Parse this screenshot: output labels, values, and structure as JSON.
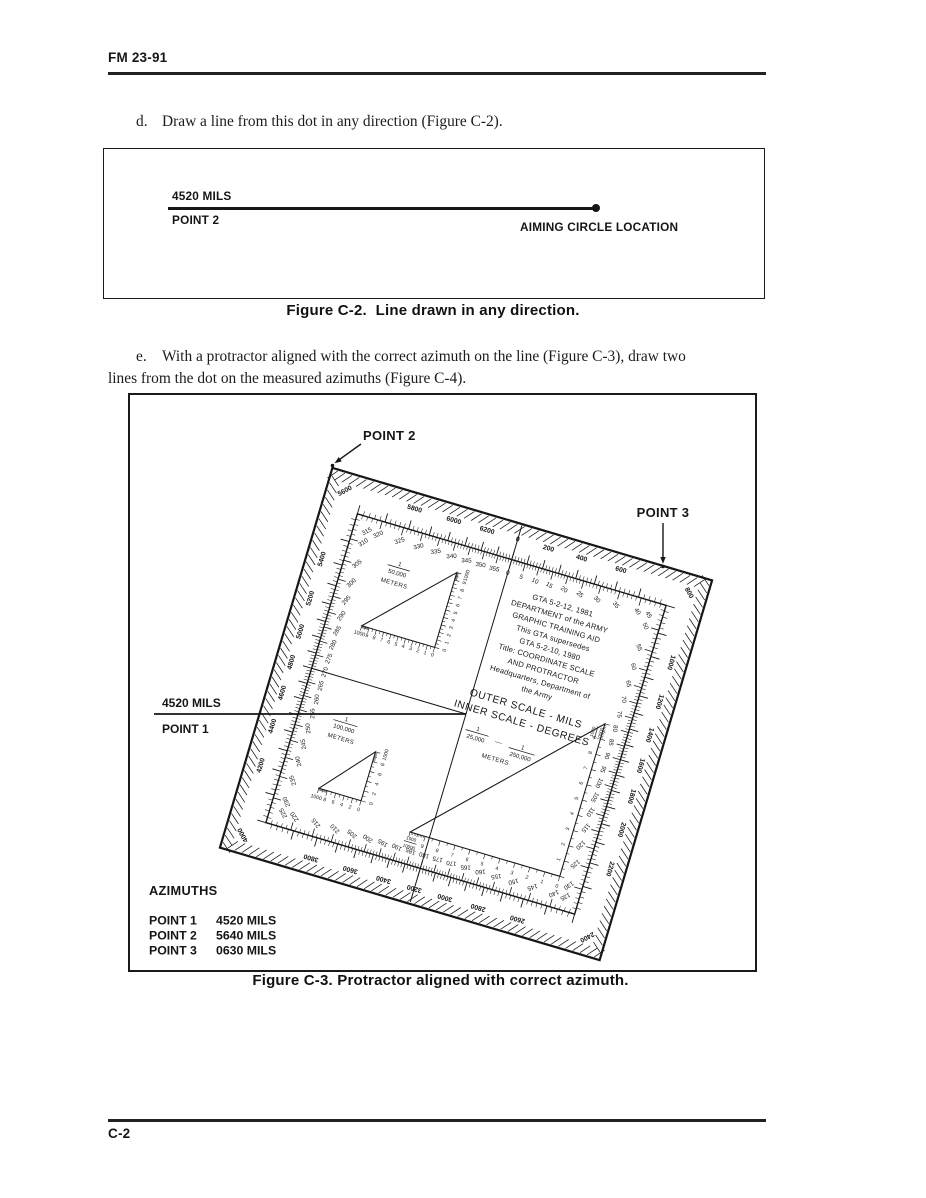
{
  "page": {
    "header_code": "FM 23-91",
    "footer_code": "C-2"
  },
  "paragraphs": {
    "d": {
      "label": "d.",
      "text": "Draw a line from this dot in any direction (Figure C-2)."
    },
    "e": {
      "label": "e.",
      "line1": "With a protractor aligned with the correct azimuth on the line (Figure C-3), draw two",
      "line2": "lines from the dot on the measured azimuths (Figure C-4)."
    }
  },
  "figure_c2": {
    "azimuth_label": "4520 MILS",
    "point_label": "POINT 2",
    "location_label": "AIMING CIRCLE LOCATION",
    "caption": "Figure C-2.  Line drawn in any direction."
  },
  "figure_c3": {
    "caption": "Figure C-3. Protractor aligned with correct azimuth.",
    "point2_label": "POINT 2",
    "point3_label": "POINT 3",
    "azimuth_line": {
      "mils": "4520 MILS",
      "point": "POINT 1"
    },
    "azimuths_table": {
      "title": "AZIMUTHS",
      "rows": [
        {
          "point": "POINT 1",
          "mils": "4520 MILS"
        },
        {
          "point": "POINT 2",
          "mils": "5640 MILS"
        },
        {
          "point": "POINT 3",
          "mils": "0630 MILS"
        }
      ]
    },
    "protractor": {
      "center_text": [
        "GTA 5-2-12, 1981",
        "DEPARTMENT of the ARMY",
        "GRAPHIC TRAINING AID",
        "This GTA supersedes",
        "GTA 5-2-10, 1980",
        "Title: COORDINATE SCALE",
        "AND PROTRACTOR",
        "Headquarters, Department of",
        "the Army"
      ],
      "scale_note": [
        "OUTER SCALE - MILS",
        "INNER SCALE - DEGREES"
      ],
      "mils_labels": [
        0,
        200,
        400,
        600,
        800,
        1000,
        1200,
        1400,
        1600,
        1800,
        2000,
        2200,
        2400,
        2600,
        2800,
        3000,
        3200,
        3400,
        3600,
        3800,
        4000,
        4200,
        4400,
        4600,
        4800,
        5000,
        5200,
        5400,
        5600,
        5800,
        6000,
        6200
      ],
      "degree_labels": [
        0,
        5,
        10,
        15,
        20,
        25,
        30,
        35,
        40,
        45,
        50,
        55,
        60,
        65,
        70,
        75,
        80,
        85,
        90,
        95,
        100,
        105,
        110,
        115,
        120,
        125,
        130,
        135,
        140,
        145,
        150,
        155,
        160,
        165,
        170,
        175,
        180,
        185,
        190,
        195,
        200,
        205,
        210,
        215,
        220,
        225,
        230,
        235,
        240,
        245,
        250,
        255,
        260,
        265,
        270,
        275,
        280,
        285,
        290,
        295,
        300,
        305,
        310,
        315,
        320,
        325,
        330,
        335,
        340,
        345,
        350,
        355
      ],
      "triangles": [
        {
          "name": "scale-1-50000",
          "numerator": "1",
          "denominator": "50,000",
          "unit": "METERS",
          "bottom_scale": [
            "1000",
            "9",
            "8",
            "7",
            "6",
            "5",
            "4",
            "3",
            "2",
            "1",
            "0"
          ],
          "side_scale": [
            "0",
            "1",
            "2",
            "3",
            "4",
            "5",
            "6",
            "7",
            "8",
            "9",
            "1000"
          ]
        },
        {
          "name": "scale-1-100000",
          "numerator": "1",
          "denominator": "100,000",
          "unit": "METERS",
          "bottom_scale": [
            "1000",
            "8",
            "6",
            "4",
            "2",
            "0"
          ],
          "side_scale": [
            "0",
            "2",
            "4",
            "6",
            "8",
            "1000"
          ]
        },
        {
          "name": "scale-1-25000-250000",
          "unit": "METERS",
          "dash": "—",
          "fractions": [
            {
              "num": "1",
              "den": "25,000"
            },
            {
              "num": "1",
              "den": "250,000"
            }
          ],
          "end_fraction": {
            "num": "1000",
            "den": "10000"
          },
          "bottom_scale": [
            "9",
            "8",
            "7",
            "6",
            "5",
            "4",
            "3",
            "2",
            "1",
            "0"
          ],
          "side_scale": [
            "1",
            "2",
            "3",
            "4",
            "5",
            "6",
            "7",
            "8",
            "9"
          ]
        }
      ]
    }
  }
}
